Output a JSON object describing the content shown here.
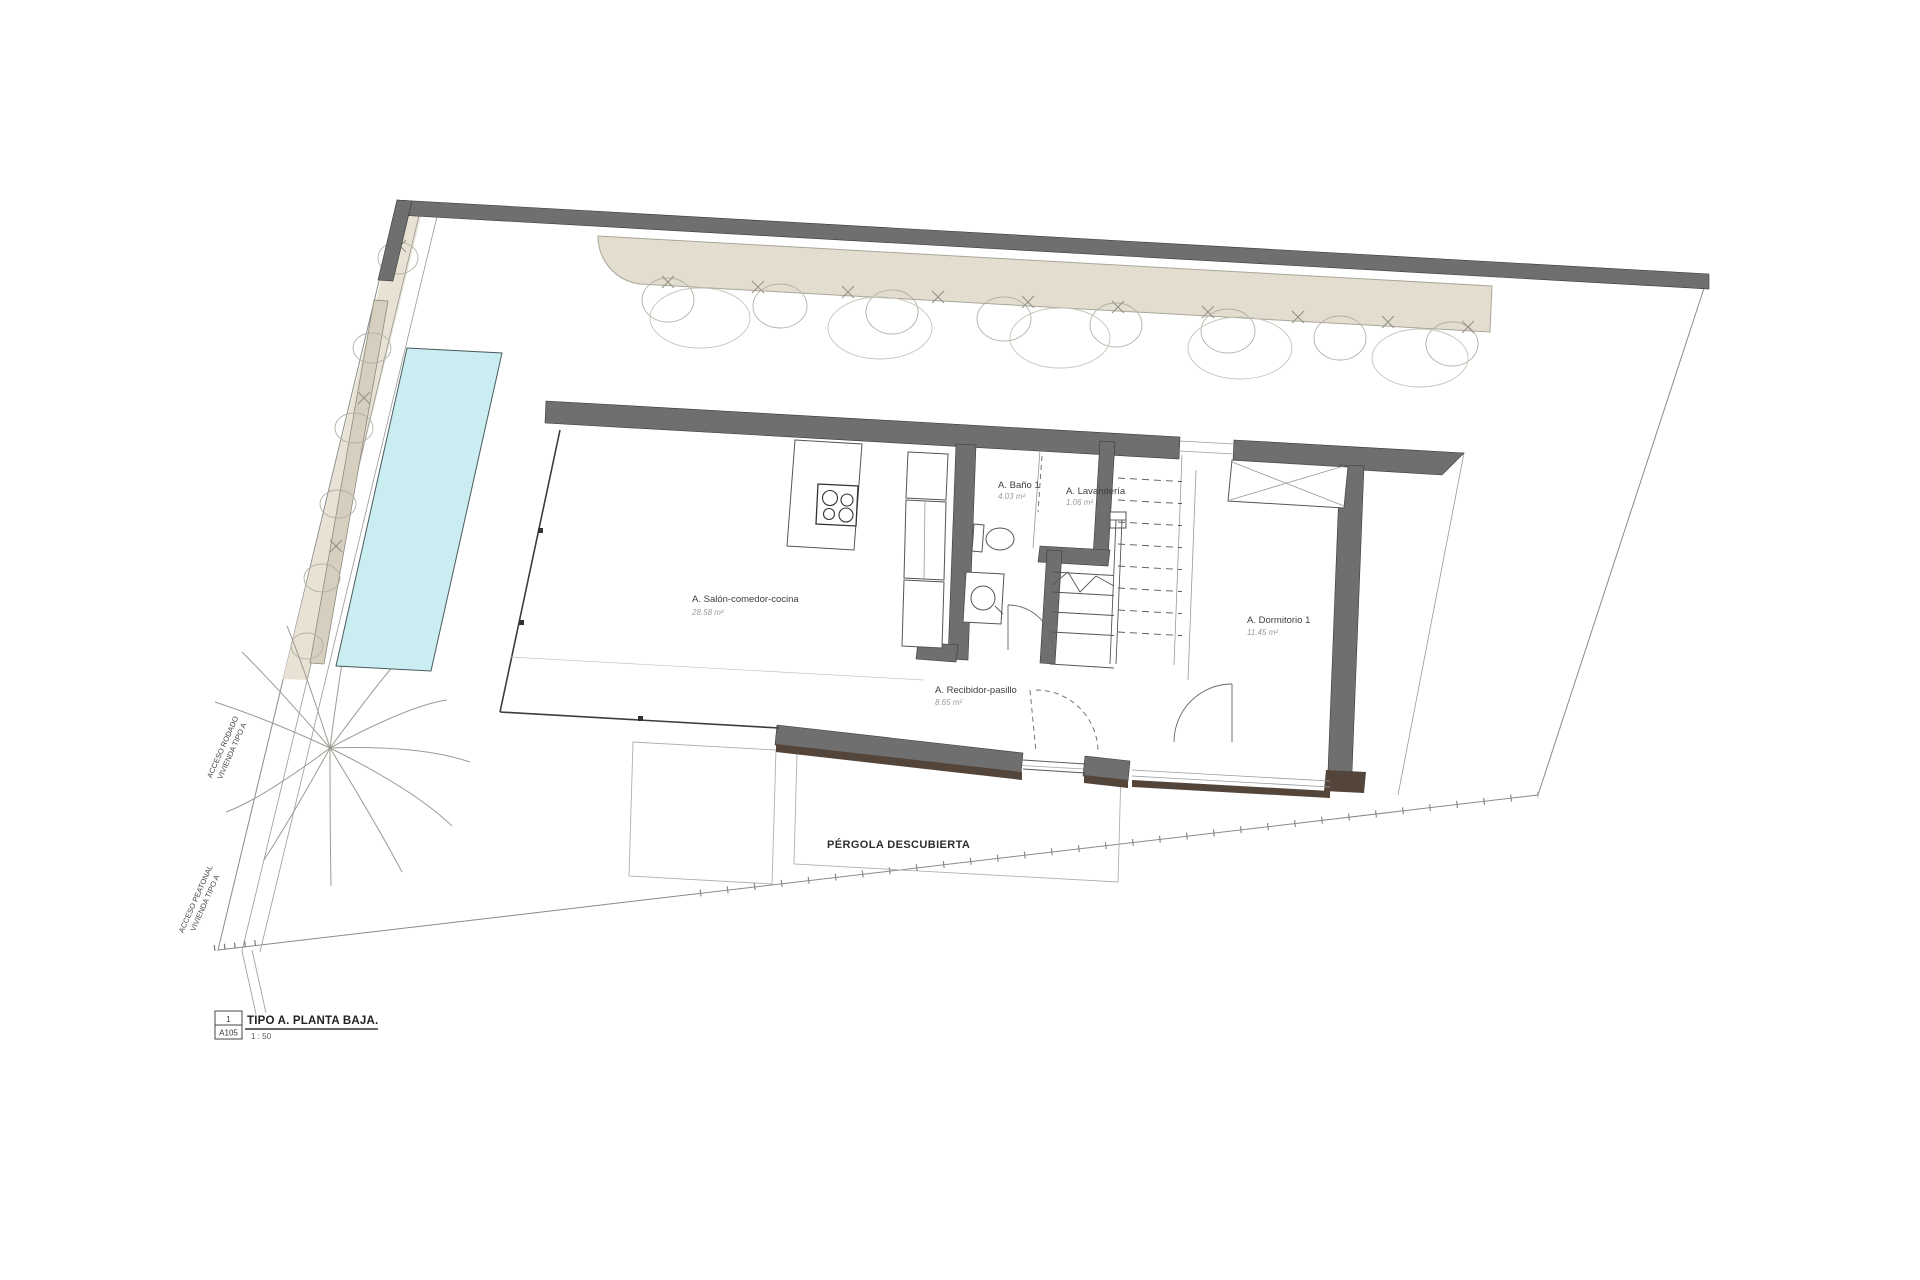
{
  "plan": {
    "rooms": [
      {
        "name": "A. Salón-comedor-cocina",
        "area": "28.58 m²"
      },
      {
        "name": "A. Baño 1",
        "area": "4.03 m²"
      },
      {
        "name": "A. Lavandería",
        "area": "1.06 m²"
      },
      {
        "name": "A. Dormitorio 1",
        "area": "11.45 m²"
      },
      {
        "name": "A. Recibidor-pasillo",
        "area": "8.65 m²"
      }
    ],
    "outdoor": {
      "pergola_label": "PÉRGOLA DESCUBIERTA"
    },
    "access": {
      "rodado_line1": "ACCESO RODADO",
      "rodado_line2": "VIVIENDA TIPO A",
      "peatonal_line1": "ACCESO PEATONAL",
      "peatonal_line2": "VIVIENDA TIPO A"
    },
    "title_block": {
      "detail_number": "1",
      "sheet": "A105",
      "title": "TIPO A. PLANTA BAJA.",
      "scale": "1 : 50"
    },
    "colors": {
      "pool": "#c9edf1",
      "wall": "#6f6f6f",
      "hedge": "#e2ddcf",
      "shadow": "#54453a"
    }
  }
}
